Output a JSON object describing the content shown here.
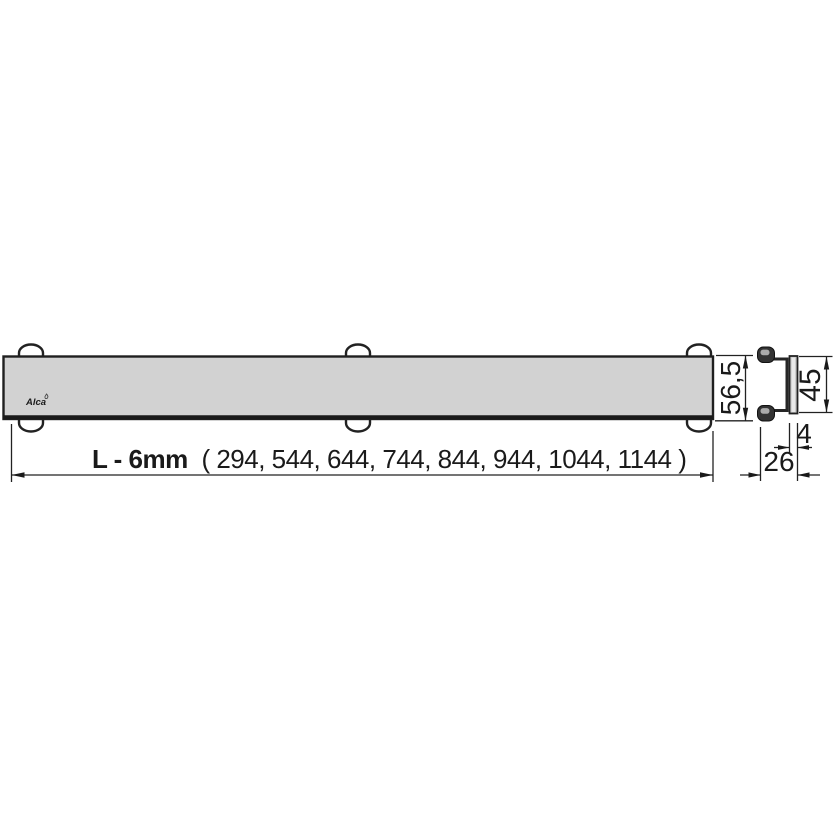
{
  "drawing": {
    "logo_text": "Alca",
    "length_dimension": {
      "label": "L - 6mm",
      "values_text": "( 294, 544, 644, 744, 844, 944, 1044, 1144 )",
      "values_mm": [
        294,
        544,
        644,
        744,
        844,
        944,
        1044,
        1144
      ]
    },
    "height_mm": "56,5",
    "side_view": {
      "plate_height_mm": "45",
      "plate_thickness_mm": "4",
      "profile_depth_mm": "26"
    },
    "colors": {
      "line": "#1f1f1f",
      "grate_fill": "#d2d2d2",
      "plate_fill": "#c6c6c6",
      "background": "#ffffff"
    }
  }
}
